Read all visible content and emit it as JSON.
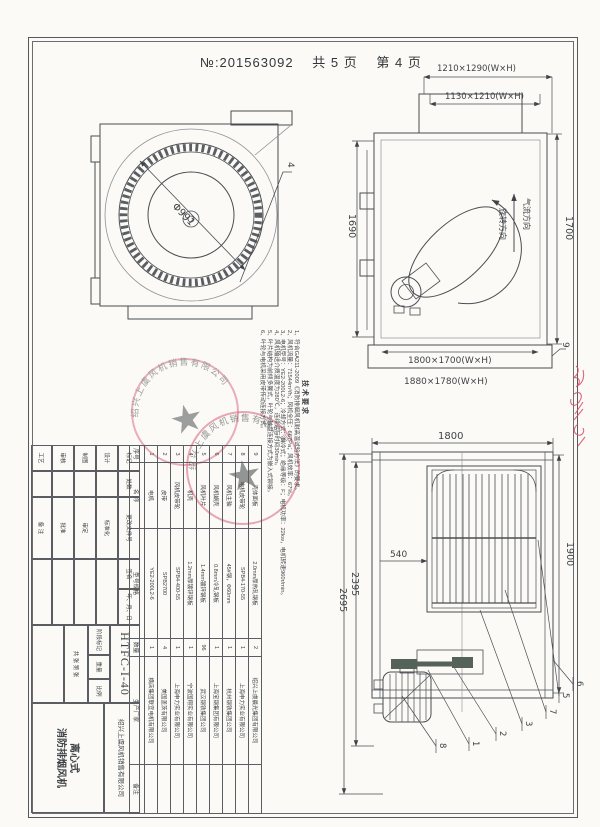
{
  "page": {
    "doc_no": "№:201563092",
    "total_pages": "共 5 页",
    "page_no": "第 4 页"
  },
  "colors": {
    "ink": "#3f4347",
    "light": "#9aa0a5",
    "red": "#d9617b",
    "dark_fill": "#55625a"
  },
  "duct_dims": {
    "outer": "1210×1290(W×H)",
    "inner": "1130×1210(W×H)"
  },
  "front_view": {
    "impeller_diameter": "Φ991",
    "leader_label": "4"
  },
  "side_view": {
    "height_left": "1690",
    "height_right": "1700",
    "airflow_label": "气流方向",
    "rotation_label": "旋转方向",
    "base_inner": "1800×1700(W×H)",
    "base_outer": "1880×1780(W×H)",
    "leader_label": "9"
  },
  "rear_view": {
    "width_top": "1800",
    "height_right": "1900",
    "height_inner": "2395",
    "height_outer": "2695",
    "grille_offset": "540",
    "leader_labels": [
      "8",
      "1",
      "2",
      "3",
      "7",
      "5",
      "6"
    ]
  },
  "tech_requirements": {
    "title": "技术要求",
    "lines": [
      "1、符合GA211-2009《消防排烟风机耐高温试验方法》的要求。",
      "2、风机流量：71544m³/h；风机全压：667Pa；风机效率：67%。",
      "3、电机型号：YE2-200L2-6；冷却方式：自冷式；绝缘等级：F；电机功率：22kw，电机转速960r/min。",
      "4、风机输送介质温度为280℃，连续运行时间30min。",
      "5、叶片结构为前倾多翼式，叶轮与轴盘连接方式为嵌入式铆接。",
      "6、叶轮与电机采用皮带传动连接方式。"
    ]
  },
  "parts_table": {
    "headers": [
      "序号",
      "名 称",
      "型号规格",
      "数量",
      "生产厂家",
      "备注"
    ],
    "rows": [
      {
        "no": "1",
        "name": "电机",
        "spec": "YE2-200L2-6",
        "qty": "1",
        "maker": "横店集团联宜电机有限公司",
        "note": ""
      },
      {
        "no": "2",
        "name": "皮带",
        "spec": "SPB2700",
        "qty": "4",
        "maker": "美国盖茨有限公司",
        "note": ""
      },
      {
        "no": "3",
        "name": "风机皮带轮",
        "spec": "SPB4-400-55",
        "qty": "1",
        "maker": "上海申力实业有限公司",
        "note": ""
      },
      {
        "no": "4",
        "name": "机壳",
        "spec": "1.2mm厚镀锌钢板",
        "qty": "1",
        "maker": "宁波国翔实业有限公司",
        "note": ""
      },
      {
        "no": "5",
        "name": "风机叶片",
        "spec": "1.4mm镀锌钢板",
        "qty": "96",
        "maker": "武汉钢铁集团公司",
        "note": ""
      },
      {
        "no": "6",
        "name": "风机蜗壳",
        "spec": "0.8mm冷轧钢板",
        "qty": "1",
        "maker": "上海宝钢集团有限公司",
        "note": ""
      },
      {
        "no": "7",
        "name": "风机主轴",
        "spec": "45#钢，Φ60mm",
        "qty": "1",
        "maker": "杭州钢铁集团公司",
        "note": ""
      },
      {
        "no": "8",
        "name": "电机皮带轮",
        "spec": "SPB4-170-55",
        "qty": "1",
        "maker": "上海申力实业有限公司",
        "note": ""
      },
      {
        "no": "9",
        "name": "壳体面板",
        "spec": "2.0mm厚热轧钢板",
        "qty": "2",
        "maker": "绍兴上虞晨光集团有限公司",
        "note": ""
      }
    ]
  },
  "title_block": {
    "revision_headers": [
      "标记",
      "处数",
      "更改文件号",
      "签名",
      "年、月、日"
    ],
    "sign_labels": {
      "design": "设计",
      "draft": "制图",
      "check": "审核",
      "process": "工艺",
      "standardize": "标准化",
      "ratify": "审定",
      "approve": "批准"
    },
    "model": "HTFC-I-40",
    "stage_headers": [
      "阶段标记",
      "重量",
      "比例"
    ],
    "sheet_info": "共 张 第 张",
    "company": "绍兴上虞风机销售有限公司",
    "product_type": "离心式",
    "product_name": "消防排烟风机",
    "note_label": "备 注"
  },
  "stamp": {
    "company": "绍兴上虞风机销售有限公司"
  }
}
